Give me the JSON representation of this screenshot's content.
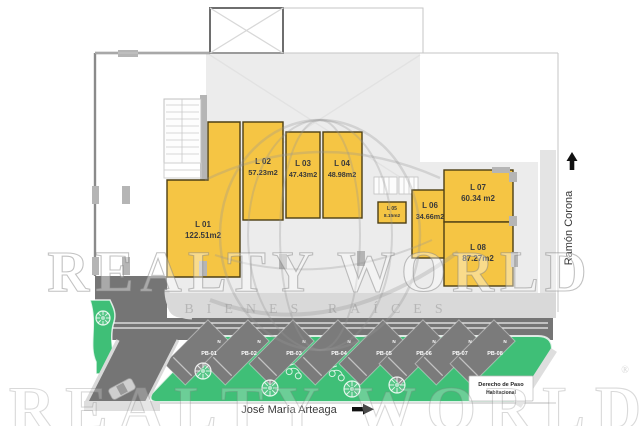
{
  "plan": {
    "lots": [
      {
        "id": "L 01",
        "area": "122.51m2"
      },
      {
        "id": "L 02",
        "area": "57.23m2"
      },
      {
        "id": "L 03",
        "area": "47.43m2"
      },
      {
        "id": "L 04",
        "area": "48.98m2"
      },
      {
        "id": "L 05",
        "area": "8.15m2"
      },
      {
        "id": "L 06",
        "area": "34.66m2"
      },
      {
        "id": "L 07",
        "area": "60.34 m2"
      },
      {
        "id": "L 08",
        "area": "87.27m2"
      }
    ],
    "parking_spaces": [
      {
        "id": "PB-01",
        "marker": "N"
      },
      {
        "id": "PB-02",
        "marker": "N"
      },
      {
        "id": "PB-03",
        "marker": "N"
      },
      {
        "id": "PB-04",
        "marker": "N"
      },
      {
        "id": "PB-05",
        "marker": "N"
      },
      {
        "id": "PB-06",
        "marker": "N"
      },
      {
        "id": "PB-07",
        "marker": "N"
      },
      {
        "id": "PB-08",
        "marker": "N"
      }
    ],
    "streets": {
      "south": "José María Arteaga",
      "east": "Ramón Corona"
    },
    "easement": {
      "line1": "Derecho de Paso",
      "line2": "Habitacional"
    },
    "watermark": {
      "brand": "REALTY WORLD",
      "tagline": "BIENES RAÍCES",
      "registered": "®"
    },
    "colors": {
      "lot": "#F5C544",
      "lot_border": "#4d3f14",
      "green": "#3FBF77",
      "road": "#757575",
      "stall": "#7b7b7b",
      "sidewalk": "#d9d9d9",
      "building": "#ececec",
      "strip": "#e4e4e4"
    }
  }
}
